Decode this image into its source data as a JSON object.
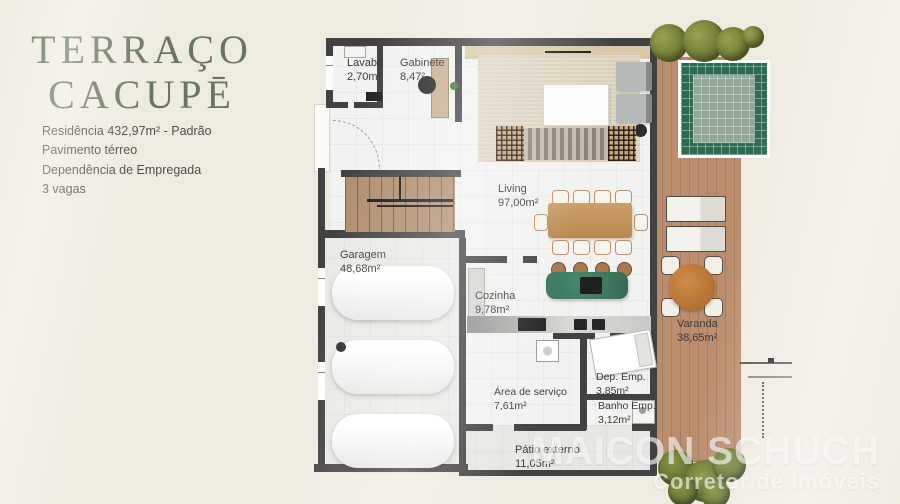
{
  "panel": {
    "title_line1": "TERRAÇO",
    "title_line2": "CACUPĒ",
    "details": [
      "Residência 432,97m² - Padrão",
      "Pavimento térreo",
      "Dependência de Empregada",
      "3 vagas"
    ]
  },
  "floorplan": {
    "rooms": {
      "lavabo": {
        "label": "Lavabo",
        "area": "2,70m²"
      },
      "gabinete": {
        "label": "Gabinete",
        "area": "8,47²"
      },
      "living": {
        "label": "Living",
        "area": "97,00m²"
      },
      "garagem": {
        "label": "Garagem",
        "area": "48,68m²"
      },
      "cozinha": {
        "label": "Cozinha",
        "area": "9,78m²"
      },
      "area_servico": {
        "label": "Área de serviço",
        "area": "7,61m²"
      },
      "dep_emp": {
        "label": "Dep. Emp.",
        "area": "3,85m²"
      },
      "banho_emp": {
        "label": "Banho Emp.",
        "area": "3,12m²"
      },
      "patio_externo": {
        "label": "Pátio externo",
        "area": "11,05m²"
      },
      "varanda": {
        "label": "Varanda",
        "area": "38,65m²"
      }
    }
  },
  "watermark": {
    "line1": "MAICON SCHUCH",
    "line2": "Corretor de Imóveis"
  },
  "colors": {
    "background": "#eeebe1",
    "title_green": "#68775c",
    "wall": "#424242",
    "deck_wood": "#bb8e6d",
    "pool_green": "#2e6b50",
    "island_green": "#3d7a60",
    "table_wood": "#c0955f",
    "watermark_white": "rgba(255,255,255,0.62)"
  }
}
